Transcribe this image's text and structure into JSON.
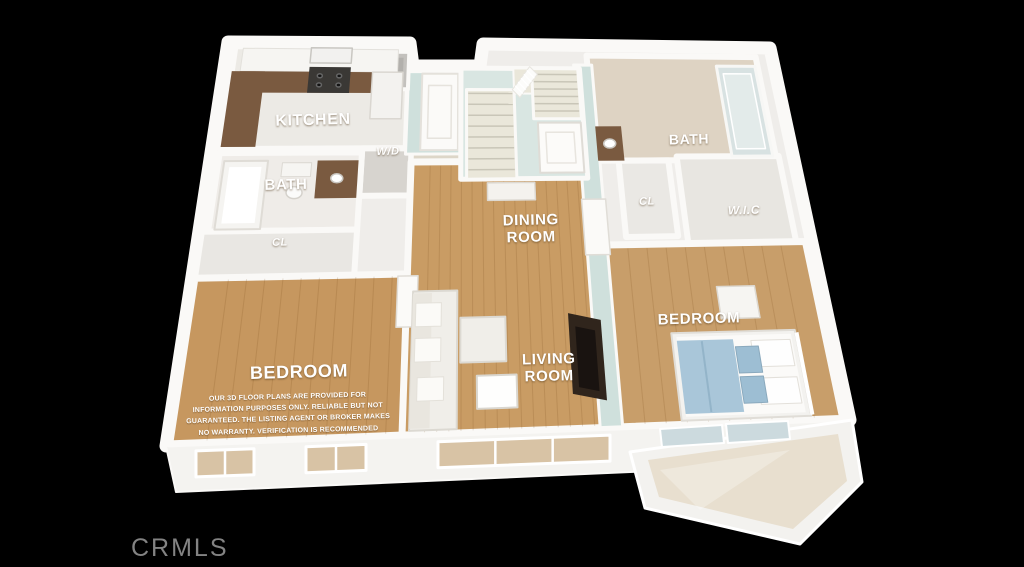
{
  "watermark": "CRMLS",
  "rooms": {
    "kitchen": "KITCHEN",
    "washer_dryer": "W/D",
    "bath_left": "BATH",
    "closet_left": "CL",
    "dining": "DINING\nROOM",
    "living": "LIVING\nROOM",
    "bedroom_left": "BEDROOM",
    "bath_right": "BATH",
    "closet_right": "CL",
    "wic": "W.I.C",
    "bedroom_right": "BEDROOM"
  },
  "disclaimer": "OUR 3D FLOOR PLANS ARE PROVIDED FOR\nINFORMATION PURPOSES ONLY. RELIABLE BUT NOT\nGUARANTEED. THE LISTING AGENT OR BROKER MAKES\nNO WARRANTY. VERIFICATION IS RECOMMENDED",
  "colors": {
    "background": "#000000",
    "floor_wood": "#c99c64",
    "accent_wall": "#cfe0dc",
    "granite": "#7a5a40",
    "blanket_blue": "#a9c6d9",
    "wall_white": "#f6f5f2"
  }
}
